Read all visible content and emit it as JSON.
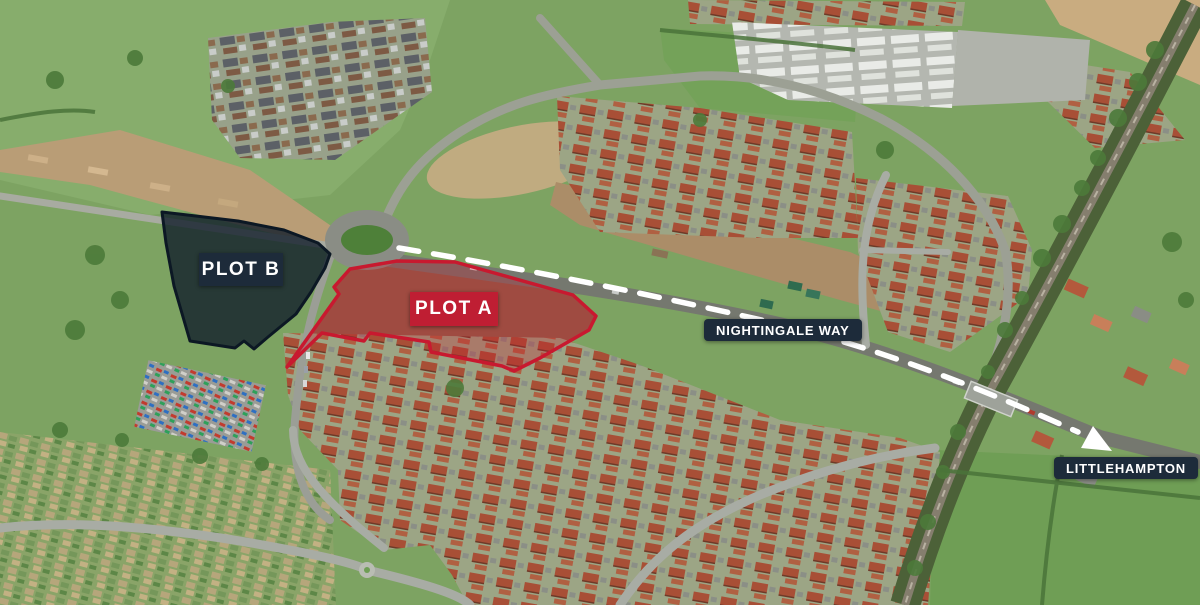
{
  "scene": {
    "type": "aerial-photo-site-plan",
    "labels": [
      "PLOT B",
      "PLOT A",
      "NIGHTINGALE WAY",
      "LITTLEHAMPTON"
    ]
  },
  "overlays": {
    "plot_b": {
      "label": "PLOT B",
      "points": "162,212 238,221 284,230 318,243 330,254 325,268 311,292 296,314 268,337 254,349 244,341 235,348 190,341 174,286 166,243",
      "fill": "rgba(17,30,44,0.80)",
      "outline": "#0c1824",
      "label_bg": "#1d2b3a"
    },
    "plot_a": {
      "label": "PLOT A",
      "points": "287,367 339,294 334,287 350,269 397,261 455,262 573,295 596,316 589,330 540,358 514,371 502,366 431,352 429,342 370,333 364,341 322,333",
      "fill": "rgba(198,28,46,0.30)",
      "outline": "#c8192f",
      "label_bg": "#bf1e33"
    },
    "route": {
      "path": "M 399 248 C 520 268, 640 292, 770 322 C 880 348, 985 390, 1078 432",
      "dasharray": "20 15",
      "color": "#ffffff",
      "arrow_points": "1112,451 1093,426 1081,448"
    },
    "road_label": {
      "text": "NIGHTINGALE WAY",
      "bg": "#1d2b3a"
    },
    "destination_label": {
      "text": "LITTLEHAMPTON",
      "bg": "#1d2b3a"
    }
  },
  "colors": {
    "plot_red": "#c8192f",
    "label_navy": "#1d2b3a",
    "label_red": "#bf1e33",
    "route_white": "#ffffff"
  }
}
